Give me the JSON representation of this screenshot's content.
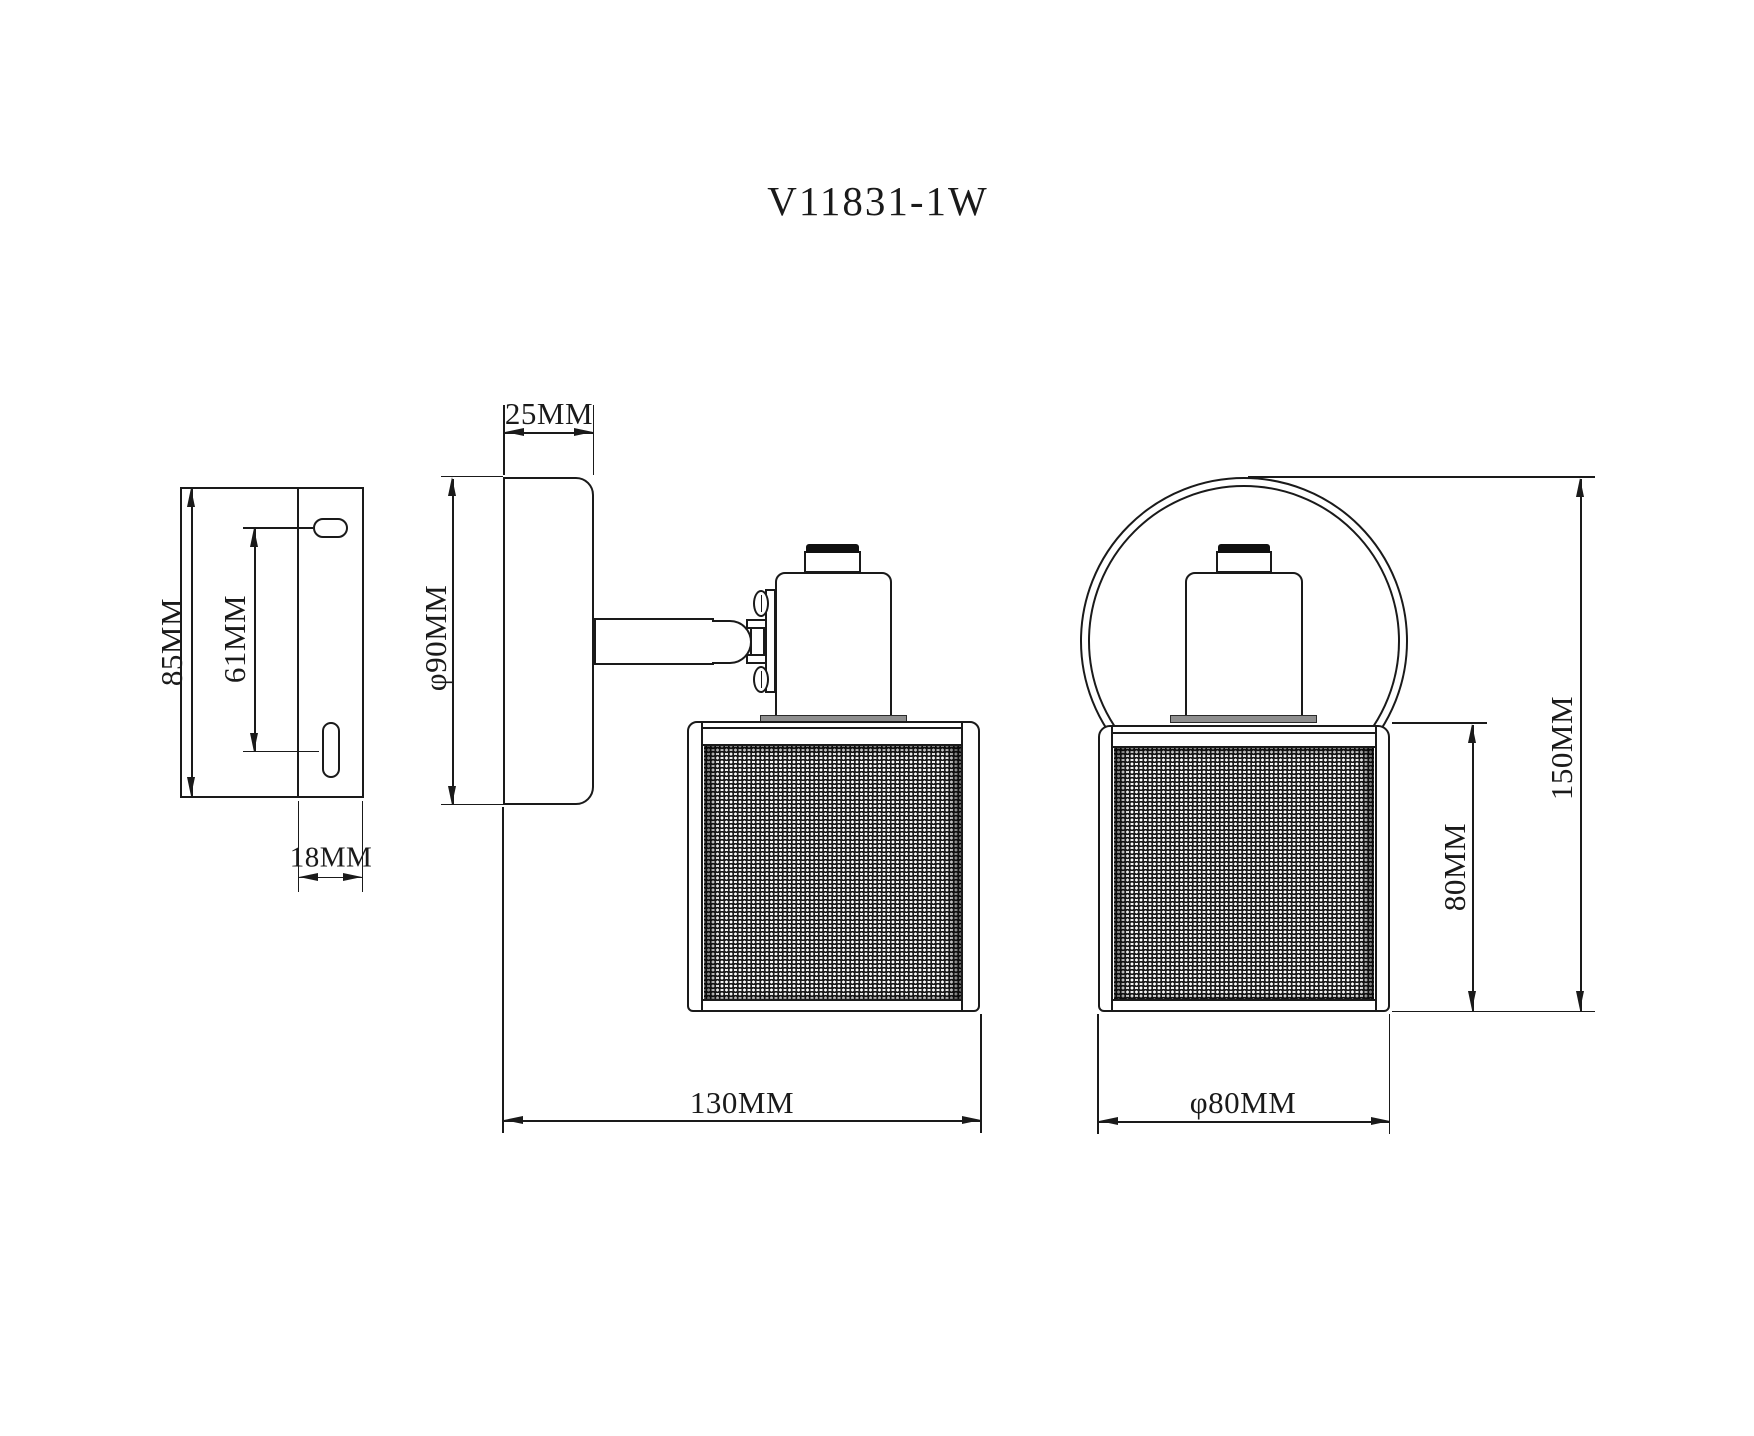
{
  "title": "V11831-1W",
  "colors": {
    "line": "#1a1a1a",
    "background": "#ffffff",
    "flange": "#8f8f8f",
    "socket_band": "#101010"
  },
  "views": {
    "bracket": {
      "label": "wall-bracket-side-view",
      "dims": {
        "plate_height": "85MM",
        "slot_spacing": "61MM",
        "plate_depth": "18MM"
      }
    },
    "side": {
      "label": "sconce-side-view",
      "dims": {
        "canopy_depth": "25MM",
        "canopy_diameter": "φ90MM",
        "projection": "130MM"
      }
    },
    "front": {
      "label": "sconce-front-view",
      "dims": {
        "overall_height": "150MM",
        "shade_height": "80MM",
        "shade_diameter": "φ80MM"
      }
    }
  }
}
